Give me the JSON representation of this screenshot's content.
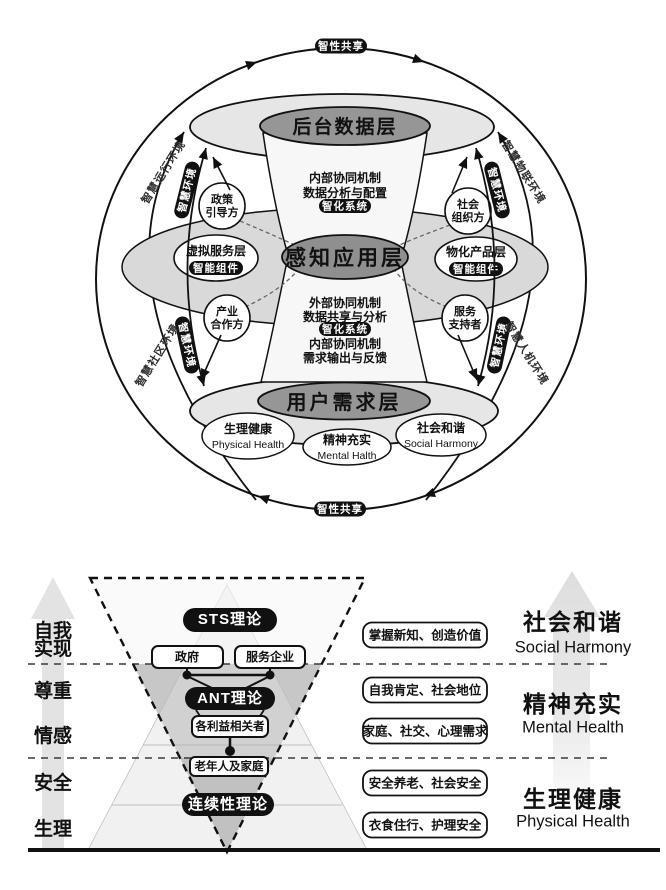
{
  "figure1": {
    "cycle": {
      "top": "智性共享",
      "bottom": "智性共享"
    },
    "env": {
      "tl_label": "智慧运行环境",
      "tr_label": "智慧物联环境",
      "bl_label": "智慧社区环境",
      "br_label": "智慧人机环境",
      "tl_pill": "智慧环境",
      "tr_pill": "智慧环境",
      "bl_pill": "智慧环境",
      "br_pill": "智慧环境"
    },
    "layers": {
      "top": "后台数据层",
      "middle": "感知应用层",
      "bottom": "用户需求层"
    },
    "top_block": {
      "line1": "内部协同机制",
      "line2": "数据分析与配置",
      "pill": "智化系统"
    },
    "bottom_block": {
      "line1": "外部协同机制",
      "line2": "数据共享与分析",
      "pill": "智化系统",
      "line3": "内部协同机制",
      "line4": "需求输出与反馈"
    },
    "stakeholders": {
      "tl1": "政策",
      "tl2": "引导方",
      "tr1": "社会",
      "tr2": "组织方",
      "bl1": "产业",
      "bl2": "合作方",
      "br1": "服务",
      "br2": "支持者"
    },
    "equator": {
      "left_title": "虚拟服务层",
      "left_pill": "智能组件",
      "right_title": "物化产品层",
      "right_pill": "智能组件"
    },
    "needs": [
      {
        "zh": "生理健康",
        "en": "Physical Health"
      },
      {
        "zh": "精神充实",
        "en": "Mental Halth"
      },
      {
        "zh": "社会和谐",
        "en": "Social Harmony"
      }
    ]
  },
  "figure2": {
    "left_levels": {
      "l1a": "自我",
      "l1b": "实现",
      "l2": "尊重",
      "l3": "情感",
      "l4": "安全",
      "l5": "生理"
    },
    "theories": {
      "sts": "STS理论",
      "ant": "ANT理论",
      "continuity": "连续性理论"
    },
    "actors": {
      "gov": "政府",
      "enterprise": "服务企业",
      "stakeholders": "各利益相关者",
      "family": "老年人及家庭"
    },
    "right_boxes": [
      "掌握新知、创造价值",
      "自我肯定、社会地位",
      "家庭、社交、心理需求",
      "安全养老、社会安全",
      "衣食住行、护理安全"
    ],
    "outcomes": [
      {
        "zh": "社会和谐",
        "en": "Social Harmony"
      },
      {
        "zh": "精神充实",
        "en": "Mental Health"
      },
      {
        "zh": "生理健康",
        "en": "Physical Health"
      }
    ]
  }
}
